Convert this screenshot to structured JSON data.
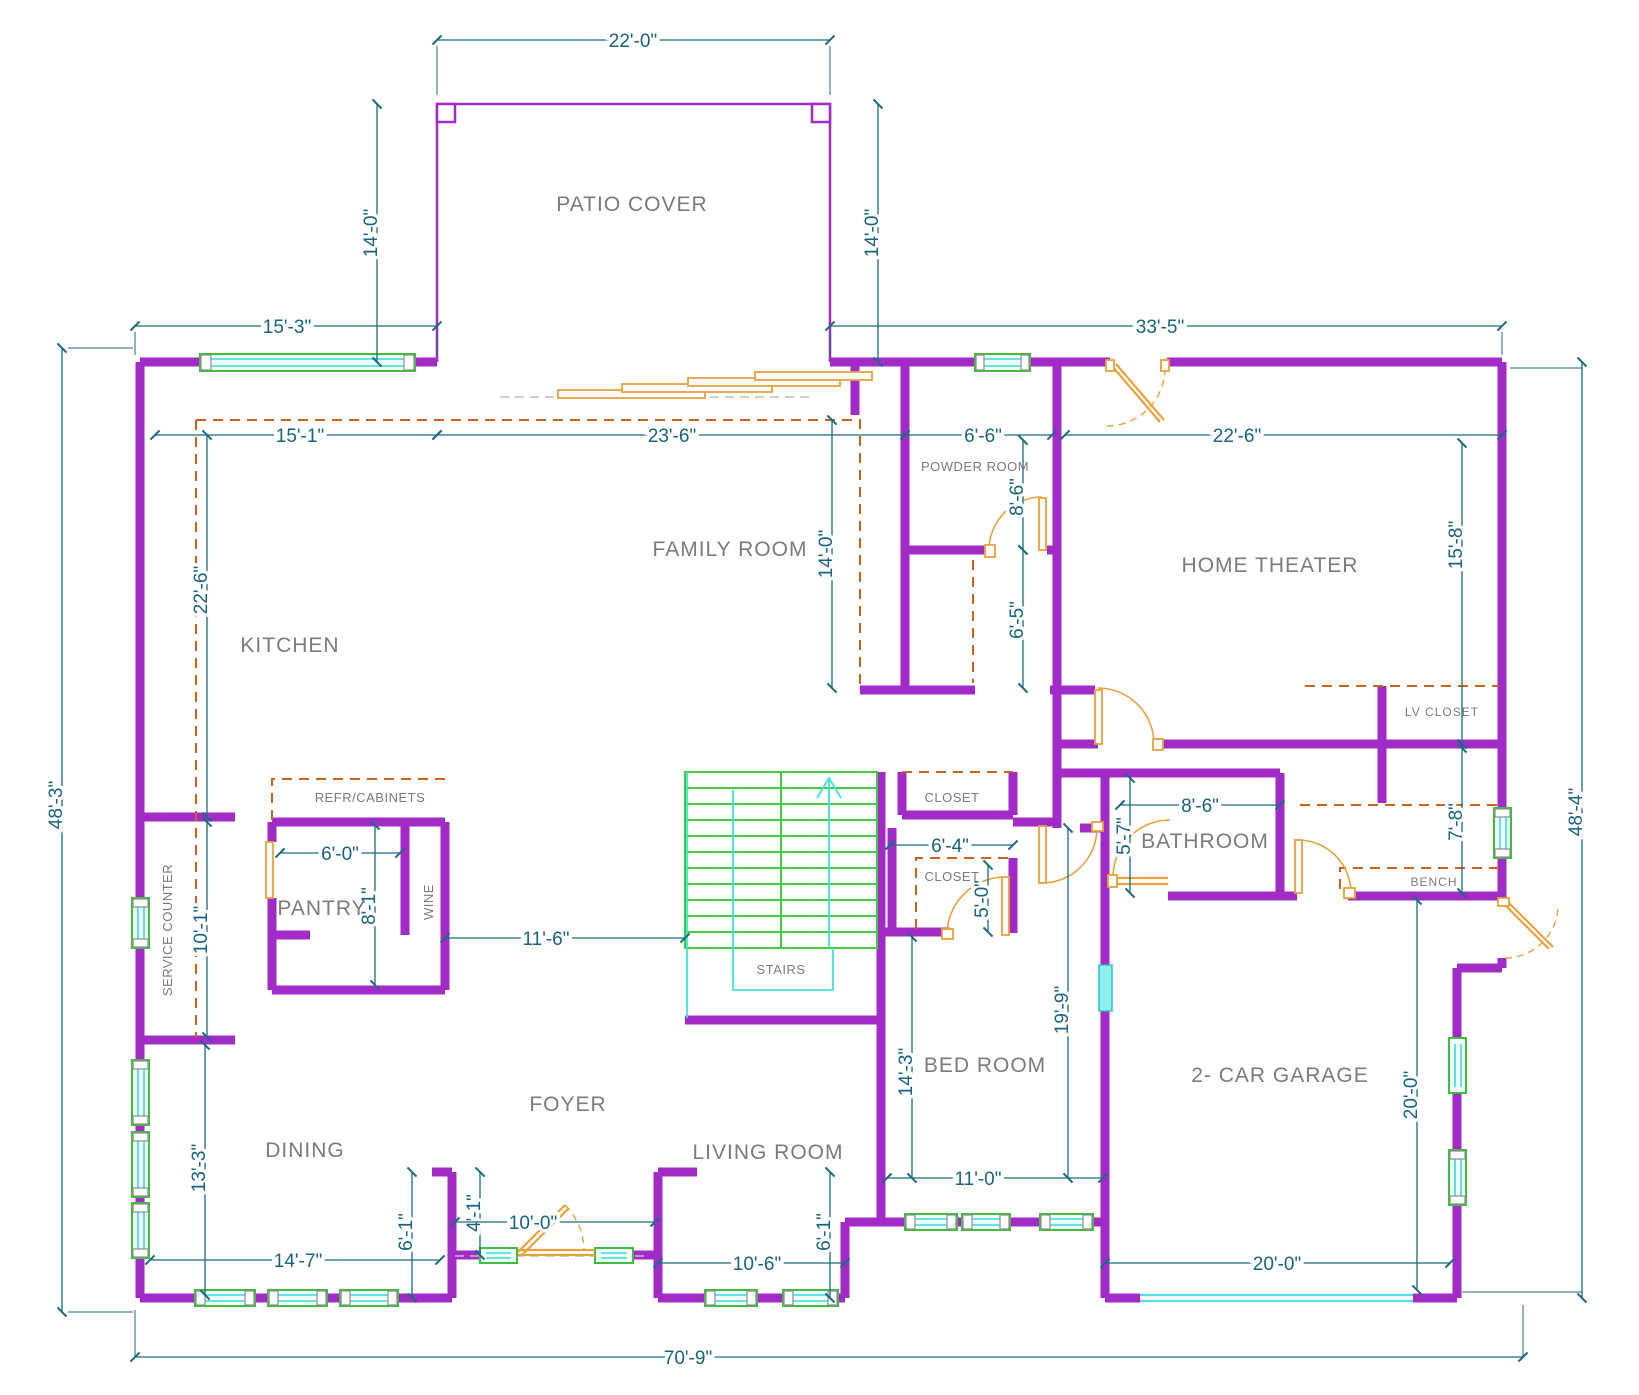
{
  "colors": {
    "wall": "#A22BC8",
    "dimension": "#1A6B80",
    "room_label": "#7B7B7B",
    "door": "#E8A23C",
    "counter_dashed": "#C8641E",
    "window_frame": "#3FBF3F",
    "window_glass": "#35DEDE",
    "stairs": "#3FCC3F",
    "stairs_accent": "#40E0E0",
    "garage_door": "#55DDE5"
  },
  "labels": {
    "patio_cover": "PATIO COVER",
    "family_room": "FAMILY ROOM",
    "kitchen": "KITCHEN",
    "powder_room": "POWDER ROOM",
    "home_theater": "HOME THEATER",
    "lv_closet": "LV CLOSET",
    "service_counter": "SERVICE COUNTER",
    "refr_cabinets": "REFR/CABINETS",
    "pantry": "PANTRY",
    "wine": "WINE",
    "stairs": "STAIRS",
    "closet_upper": "CLOSET",
    "closet_lower": "CLOSET",
    "bathroom": "BATHROOM",
    "bench": "BENCH",
    "dining": "DINING",
    "foyer": "FOYER",
    "living_room": "LIVING ROOM",
    "bed_room": "BED ROOM",
    "garage": "2- CAR GARAGE"
  },
  "dims": {
    "d22_0": "22'-0\"",
    "d14_0_patio_left": "14'-0\"",
    "d14_0_patio_right": "14'-0\"",
    "d15_3": "15'-3\"",
    "d33_5": "33'-5\"",
    "d48_3": "48'-3\"",
    "d48_4": "48'-4\"",
    "d70_9": "70'-9\"",
    "d15_1": "15'-1\"",
    "d23_6": "23'-6\"",
    "d6_6": "6'-6\"",
    "d22_6_theater": "22'-6\"",
    "d8_6_powder": "8'-6\"",
    "d14_0_family": "14'-0\"",
    "d6_5": "6'-5\"",
    "d15_8": "15'-8\"",
    "d22_6_kitchen": "22'-6\"",
    "d10_1": "10'-1\"",
    "d13_3": "13'-3\"",
    "d6_0": "6'-0\"",
    "d8_1": "8'-1\"",
    "d11_6": "11'-6\"",
    "d6_4": "6'-4\"",
    "d5_0": "5'-0\"",
    "d8_6_bath": "8'-6\"",
    "d5_7": "5'-7\"",
    "d7_8": "7'-8\"",
    "d19_9": "19'-9\"",
    "d14_3": "14'-3\"",
    "d11_0": "11'-0\"",
    "d20_0_garage_v": "20'-0\"",
    "d20_0_garage_door": "20'-0\"",
    "d14_7": "14'-7\"",
    "d6_1_left": "6'-1\"",
    "d4_1": "4'-1\"",
    "d10_0": "10'-0\"",
    "d6_1_right": "6'-1\"",
    "d10_6": "10'-6\""
  }
}
